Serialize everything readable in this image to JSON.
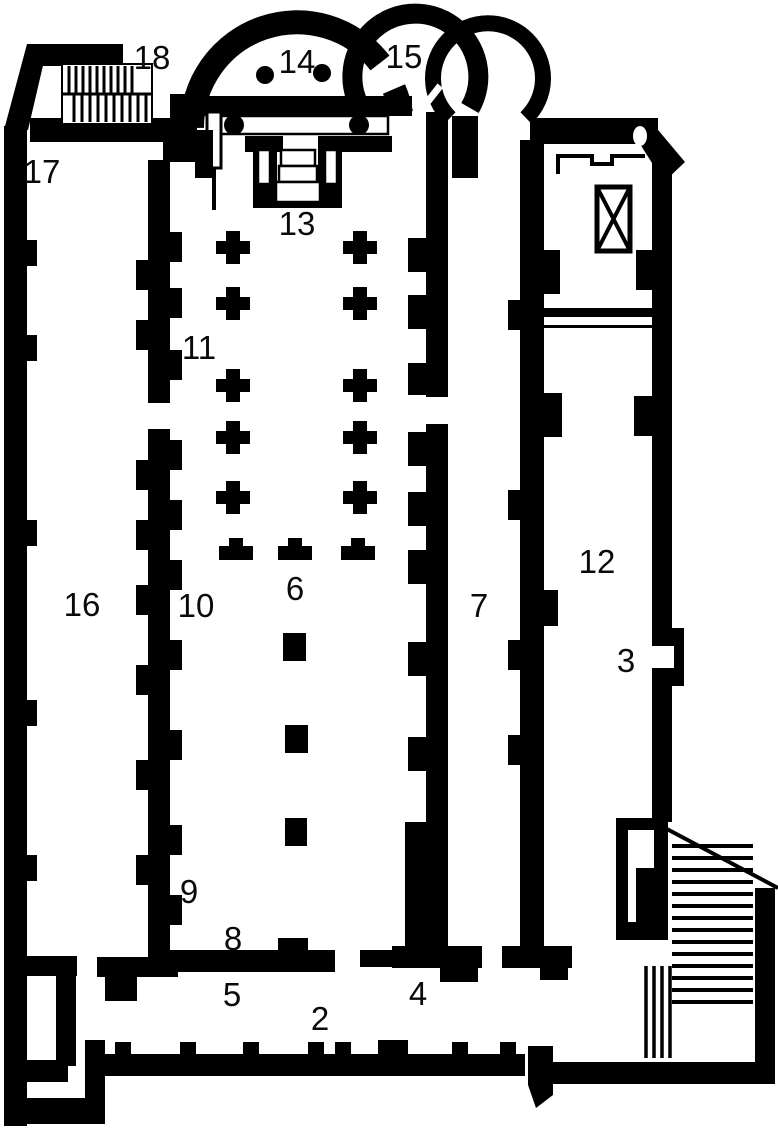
{
  "figure": {
    "type": "architectural-floor-plan",
    "subject": "basilica church ground plan, line drawing, apse at top",
    "label_style": "numeric room/feature labels"
  },
  "colors": {
    "ink": "#000000",
    "background": "#ffffff"
  },
  "labels": [
    {
      "number": "2"
    },
    {
      "number": "3"
    },
    {
      "number": "4"
    },
    {
      "number": "5"
    },
    {
      "number": "6"
    },
    {
      "number": "7"
    },
    {
      "number": "8"
    },
    {
      "number": "9"
    },
    {
      "number": "10"
    },
    {
      "number": "11"
    },
    {
      "number": "12"
    },
    {
      "number": "13"
    },
    {
      "number": "14"
    },
    {
      "number": "15"
    },
    {
      "number": "16"
    },
    {
      "number": "17"
    },
    {
      "number": "18"
    }
  ]
}
